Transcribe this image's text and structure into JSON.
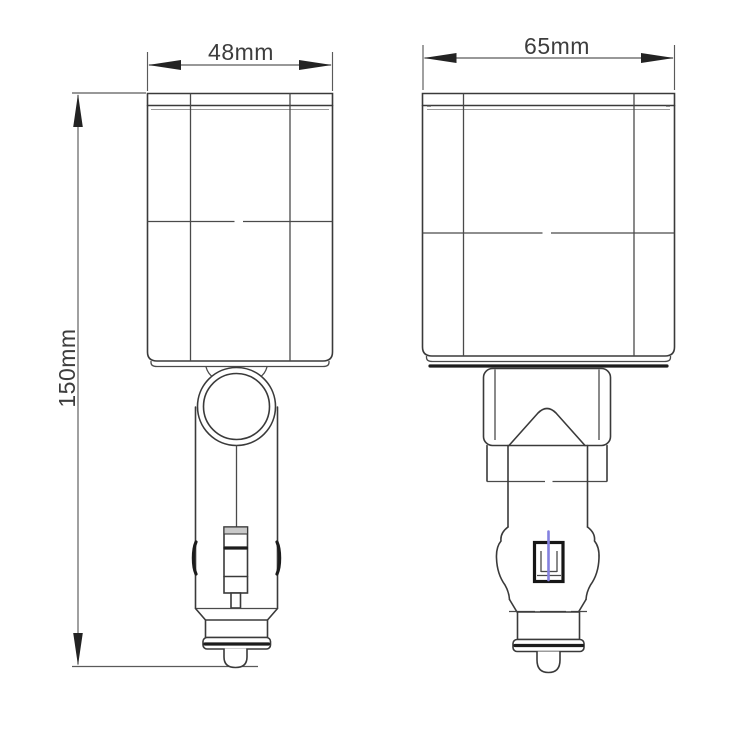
{
  "colors": {
    "line": "#3a3a3a",
    "dimension_line": "#5a5a5a",
    "accent_blue": "#8481e0",
    "background": "#ffffff"
  },
  "drawing": {
    "height_label": "150mm",
    "views": [
      {
        "name": "front-view",
        "width_label": "48mm"
      },
      {
        "name": "side-view",
        "width_label": "65mm"
      }
    ]
  }
}
